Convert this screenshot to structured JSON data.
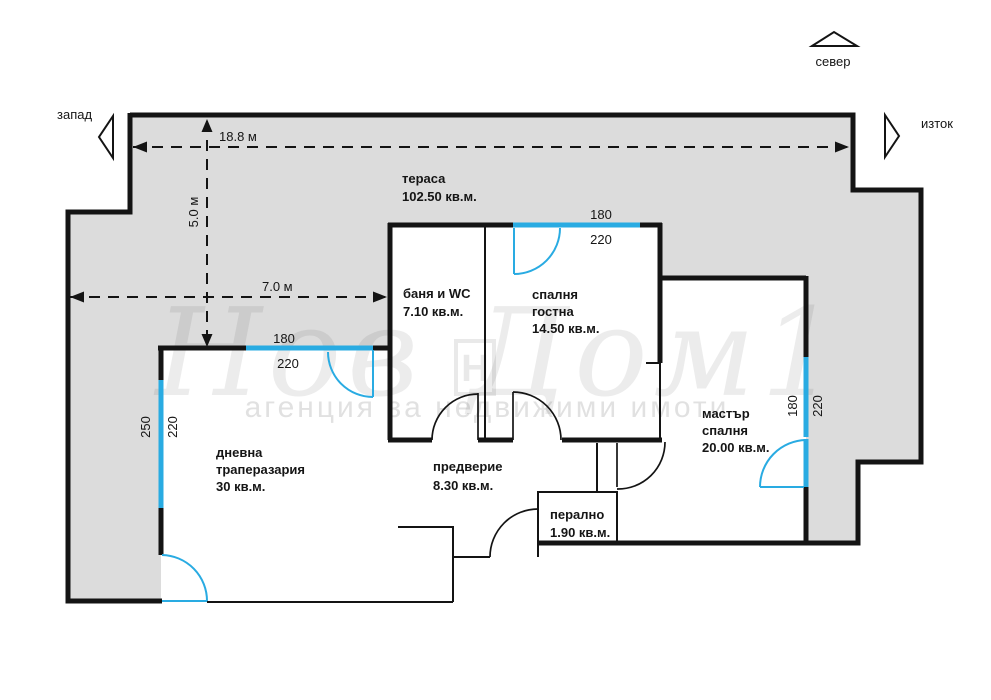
{
  "colors": {
    "wall": "#141414",
    "window": "#29abe2",
    "terrace_fill": "#dcdcdc",
    "background": "#ffffff"
  },
  "compass": {
    "north_label": "север",
    "west_label": "запад",
    "east_label": "изток"
  },
  "watermark": {
    "brand": "Нов Дом1",
    "tagline": "агенция за недвижими имоти",
    "logo_letter": "Н"
  },
  "rooms": {
    "terrace": {
      "name": "тераса",
      "area": "102.50 кв.м."
    },
    "bathroom": {
      "name": "баня и WC",
      "area": "7.10 кв.м."
    },
    "guest_bedroom": {
      "line1": "спалня",
      "line2": "гостна",
      "area": "14.50 кв.м."
    },
    "master_bedroom": {
      "line1": "мастър",
      "line2": "спалня",
      "area": "20.00 кв.м."
    },
    "living_room": {
      "line1": "дневна",
      "line2": "траперазария",
      "area": "30 кв.м."
    },
    "hallway": {
      "name": "предверие",
      "area": "8.30 кв.м."
    },
    "laundry": {
      "name": "перално",
      "area": "1.90 кв.м."
    }
  },
  "dimensions": {
    "terrace_width": "18.8 м",
    "terrace_depth": "5.0 м",
    "terrace_left_span": "7.0 м",
    "living_top_window": {
      "width": "180",
      "height": "220"
    },
    "living_left_window": {
      "width": "250",
      "height": "220"
    },
    "guest_window": {
      "width": "180",
      "height": "220"
    },
    "master_window": {
      "width": "180",
      "height": "220"
    }
  }
}
